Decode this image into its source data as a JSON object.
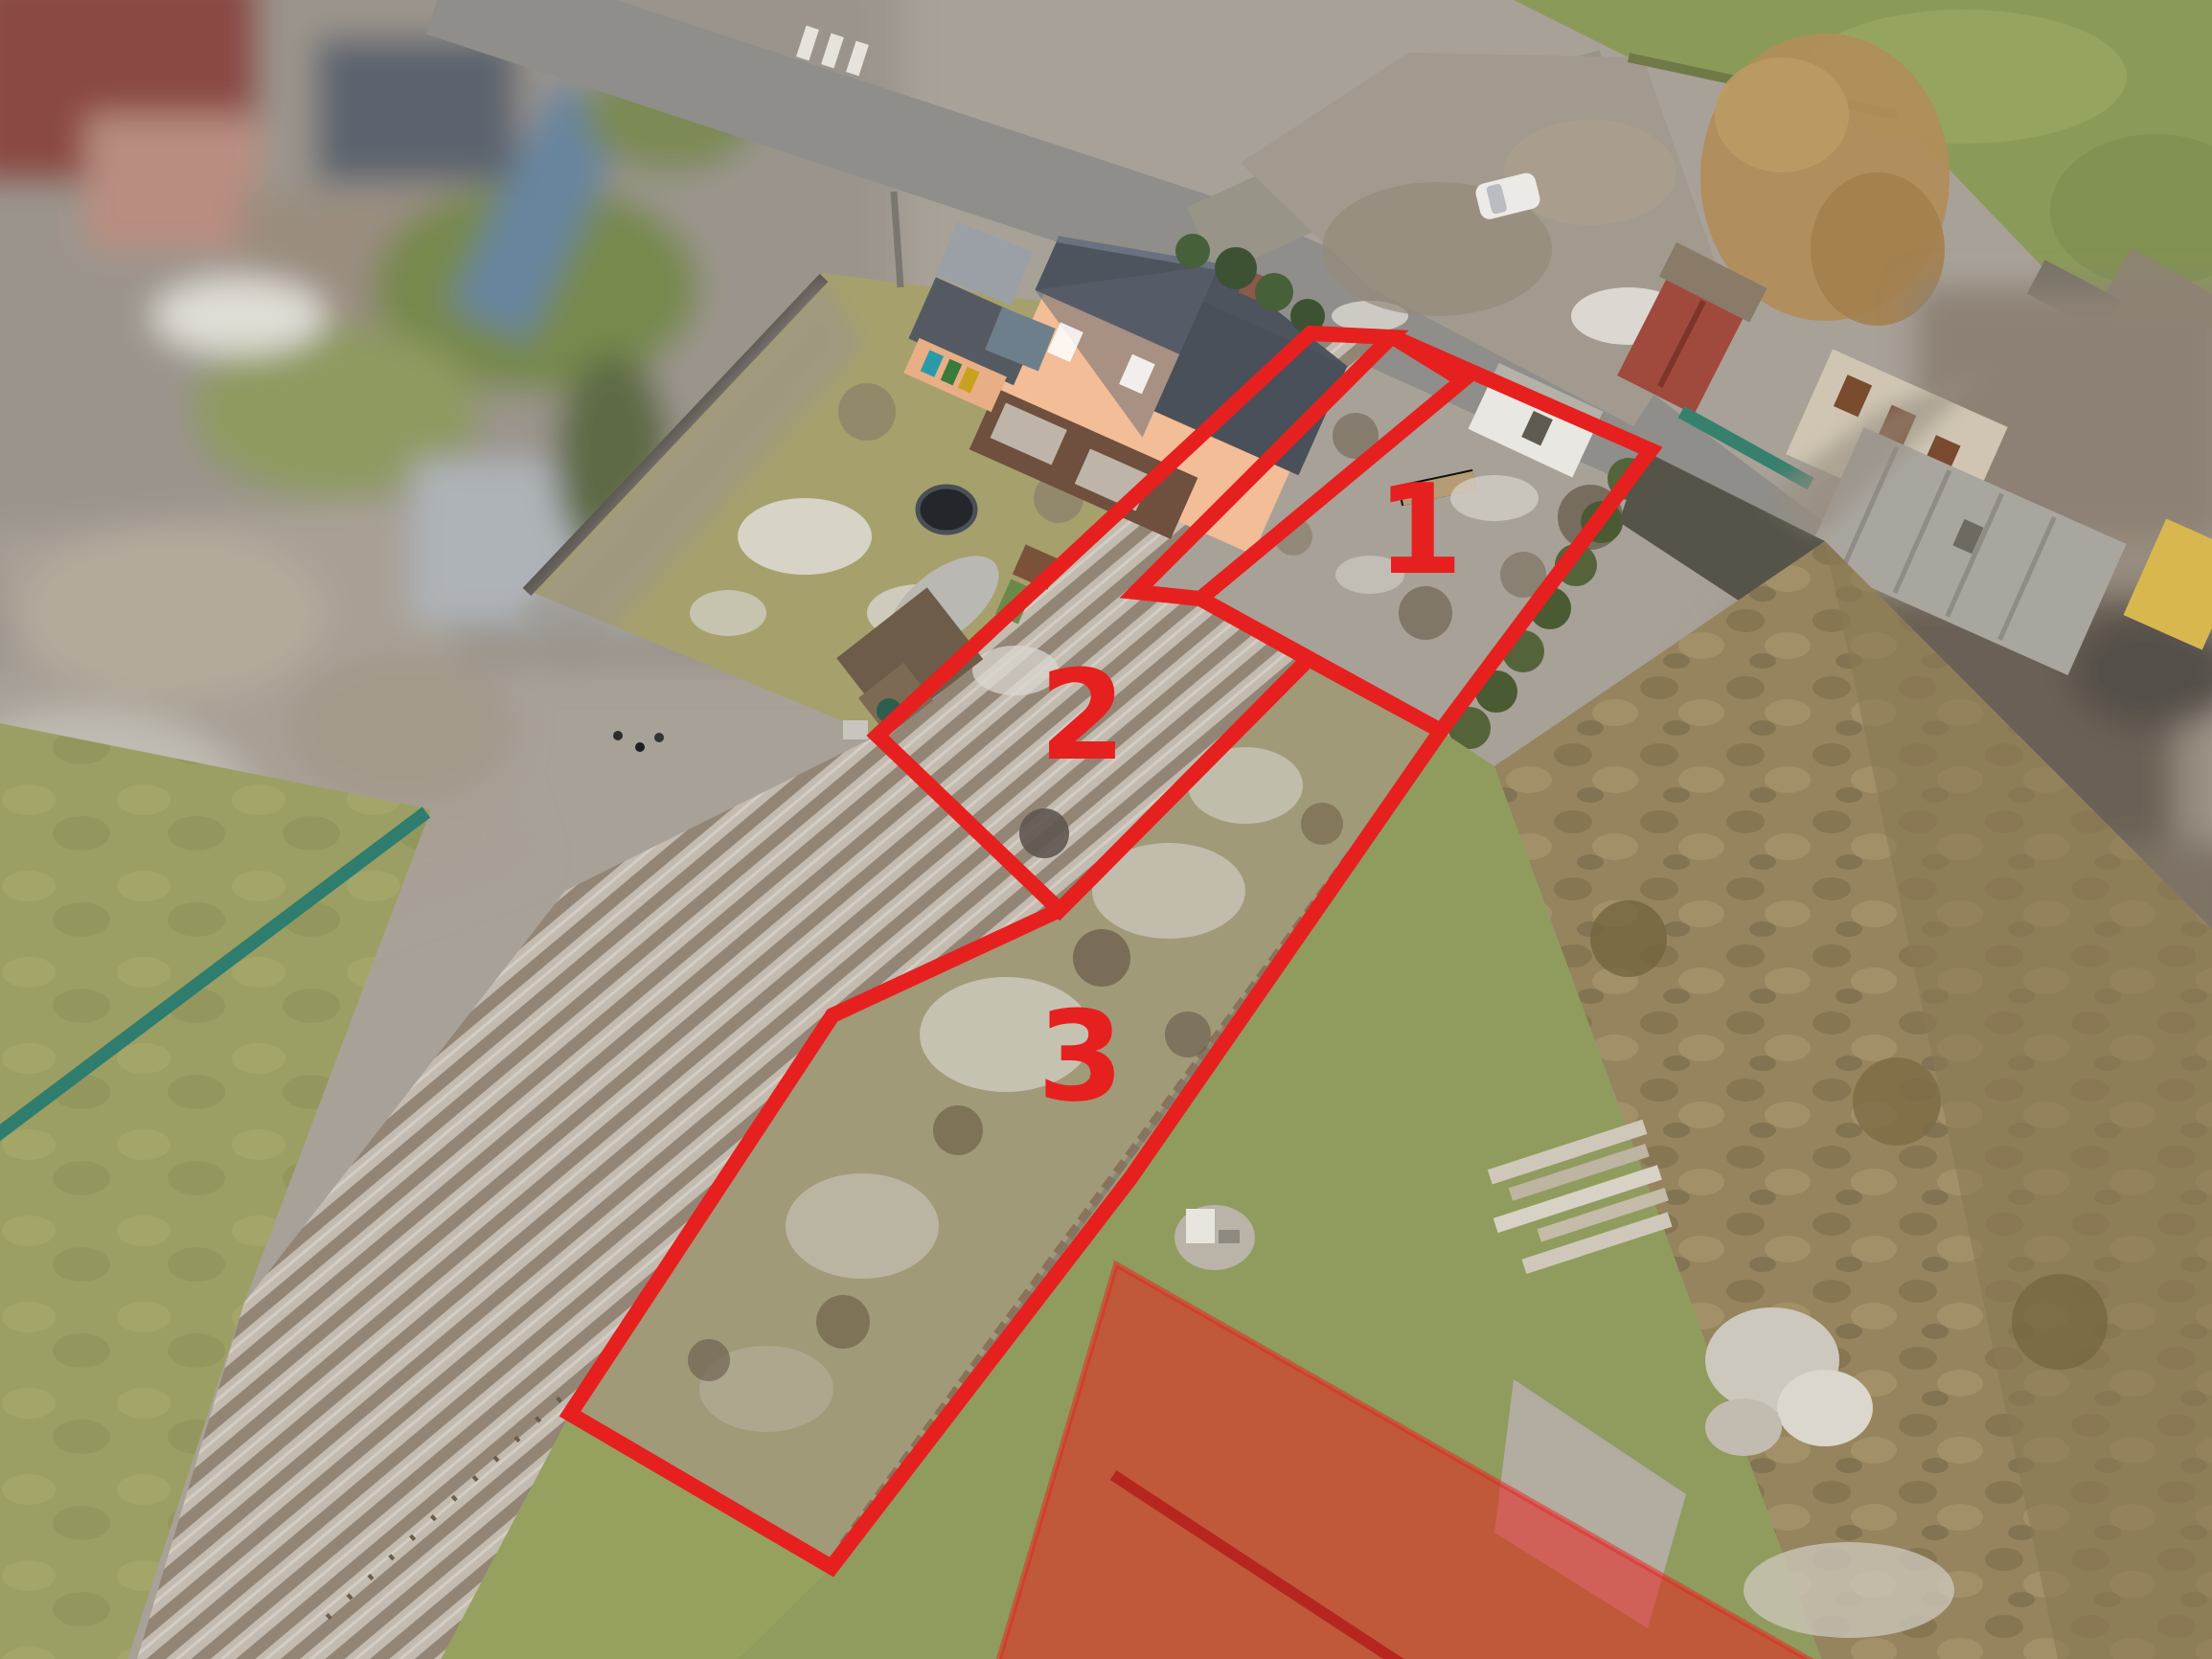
{
  "photo": {
    "kind": "aerial-drone-photograph",
    "season": "winter",
    "annotation_color": "#e6201e",
    "overlay_fill_color": "#e8231e",
    "overlay_fill_opacity": 0.55,
    "label_color": "#e6201e"
  },
  "parcels": [
    {
      "id": "parcel-1",
      "label": "1"
    },
    {
      "id": "parcel-2",
      "label": "2"
    },
    {
      "id": "parcel-3",
      "label": "3"
    }
  ]
}
